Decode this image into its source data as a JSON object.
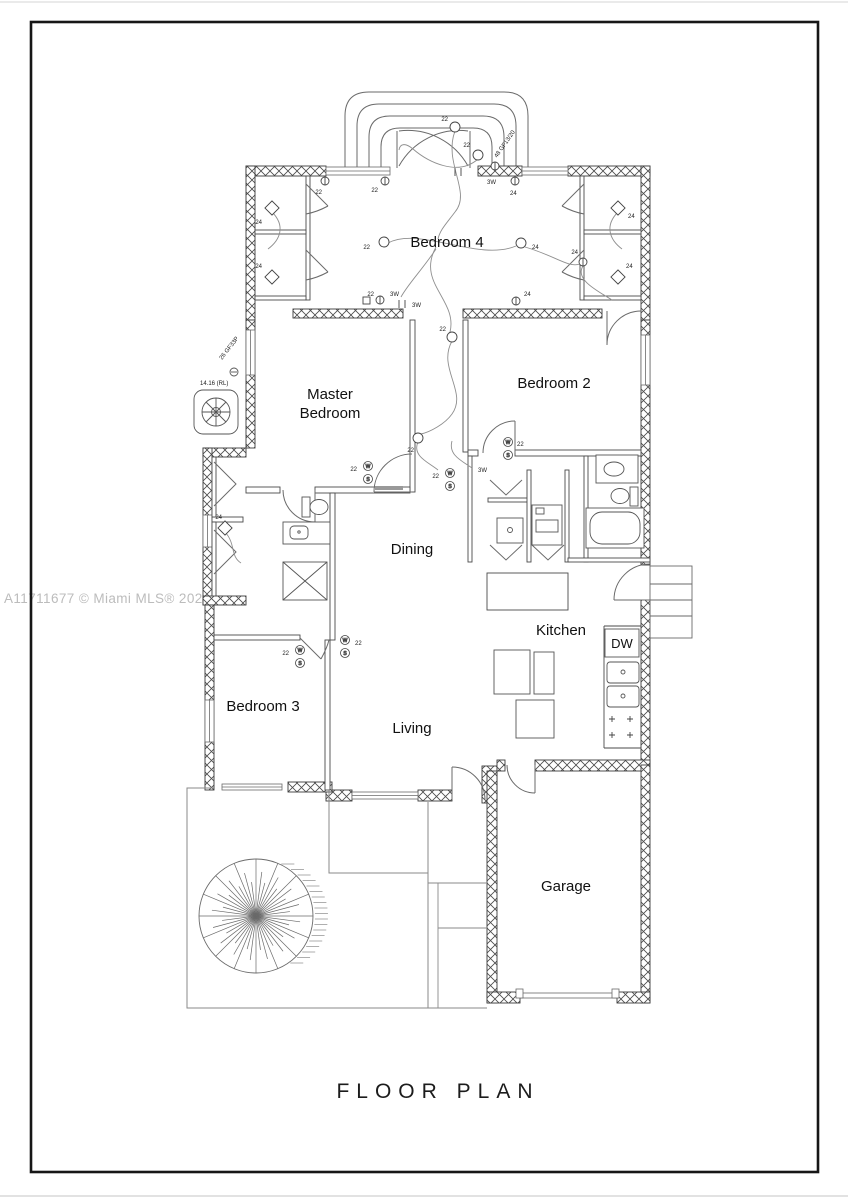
{
  "page": {
    "watermark": "A11711677 © Miami MLS® 2025",
    "title": "FLOOR PLAN"
  },
  "rooms": {
    "bedroom4": "Bedroom 4",
    "master1": "Master",
    "master2": "Bedroom",
    "bedroom2": "Bedroom 2",
    "dining": "Dining",
    "kitchen": "Kitchen",
    "bedroom3": "Bedroom 3",
    "living": "Living",
    "garage": "Garage",
    "dw": "DW"
  },
  "annotations": {
    "c22": "22",
    "c24": "24",
    "w3": "3W",
    "sw": "W",
    "ss": "S",
    "panel_main": "26 GF33P",
    "panel_rl": "14.16 (RL)",
    "panel_entry": "48 GF13/20"
  },
  "colors": {
    "ink": "#1a1a1a",
    "wall": "#3a3a3a",
    "line": "#6a6a6a",
    "watermark": "#bcbcbc",
    "background": "#ffffff"
  }
}
